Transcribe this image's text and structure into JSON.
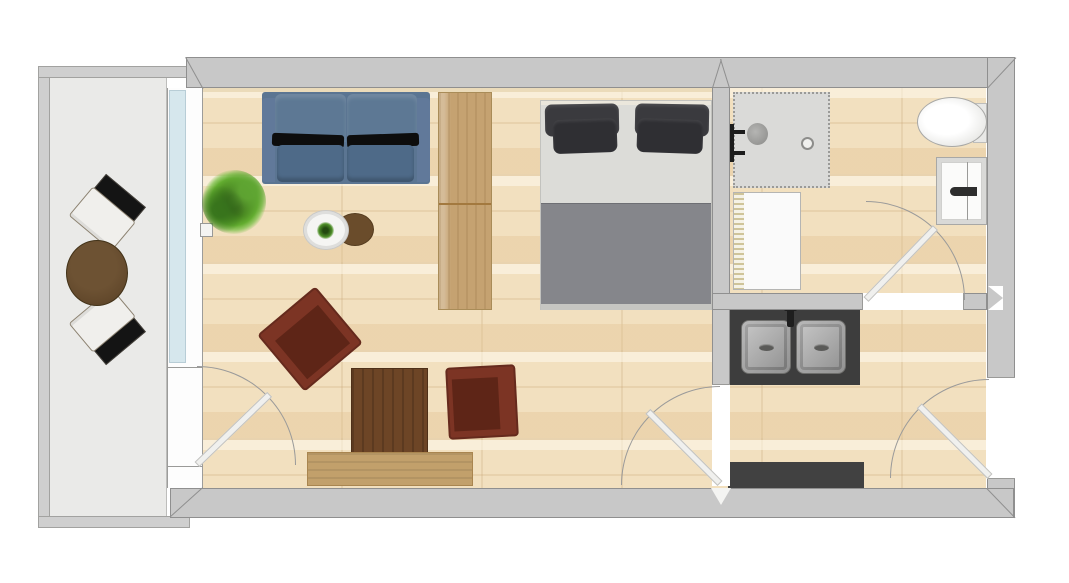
{
  "colors": {
    "bg": "#ffffff",
    "wall": "#c8c8c8",
    "wall_line": "#8f8f8f",
    "balcony_wall": "#cfcfcf",
    "balcony_floor": "#eaeae8",
    "wood_floor": "#f2e0bf",
    "glass": "#d6e7ed",
    "door_leaf": "#f0f0ee",
    "door_arc": "#9a9a9a",
    "sofa": "#5b7592",
    "sofa_seat": "#4e6a88",
    "sofa_shadow": "#0d0d0d",
    "wardrobe": "#c5a271",
    "bed_sheet": "#dcdcd8",
    "bed_blanket": "#85868b",
    "pillow": "#3a3a3e",
    "armchair": "#7c3424",
    "armchair_seat": "#5e2517",
    "desk": "#6d4526",
    "bench": "#c2a06b",
    "side_table": "#6a4c2b",
    "coffee_table": "#f5f5f3",
    "balcony_table": "#63492c",
    "chair_seat": "#f0efec",
    "chair_back": "#141414",
    "shower": "#dadad8",
    "fixture": "#1c1c1c",
    "radiator": "#fafafa",
    "radiator_hatch": "#cfc49a",
    "basin_cabinet": "#d9d9d7",
    "counter": "#3d3d3d",
    "steel_light": "#c9c9c9",
    "steel_dark": "#8f8f8f",
    "mat": "#414141"
  },
  "plan": {
    "type": "studio-apartment-floor-plan",
    "rooms": [
      "balcony",
      "living-sleeping-room",
      "bathroom",
      "kitchen"
    ],
    "furniture": {
      "balcony": [
        "chair",
        "chair",
        "round-table"
      ],
      "living_sleeping": [
        "sofa",
        "potted-plant",
        "coffee-table",
        "side-table",
        "wardrobe",
        "armchair",
        "armchair",
        "desk",
        "sideboard-bench",
        "double-bed"
      ],
      "bathroom": [
        "shower",
        "shower-fixture",
        "radiator",
        "toilet",
        "washbasin"
      ],
      "kitchen": [
        "double-sink-counter",
        "floor-mat"
      ]
    },
    "doors": [
      "balcony-door",
      "kitchen-door",
      "bathroom-door",
      "entrance-door"
    ],
    "windows": [
      "balcony-window"
    ]
  }
}
